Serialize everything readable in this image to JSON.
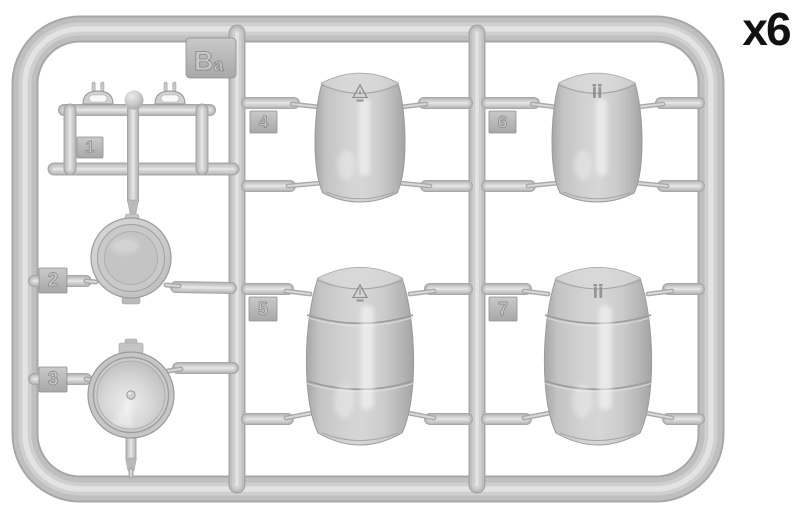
{
  "diagram": {
    "sprue_label": "Ba",
    "quantity_label": "x6",
    "palette": {
      "background": "#ffffff",
      "plastic_edge": "#a7a7a7",
      "plastic_base": "#bfbfbf",
      "plastic_mid": "#cfcfcf",
      "plastic_core": "#e3e3e3",
      "tab_stroke": "#8f8f8f",
      "emboss_fill": "#c8c8c8",
      "emboss_line": "#858585",
      "stamp_line": "#8a8a8a",
      "label_text": "#111111"
    },
    "parts": [
      {
        "number": "1",
        "name": "carry-handles-pair"
      },
      {
        "number": "2",
        "name": "flat-barrel-lid"
      },
      {
        "number": "3",
        "name": "barrel-lid-center-plug"
      },
      {
        "number": "4",
        "name": "small-barrel-half-triangle-stamp"
      },
      {
        "number": "5",
        "name": "large-barrel-triangle-stamp"
      },
      {
        "number": "6",
        "name": "small-barrel-half-jug-stamp"
      },
      {
        "number": "7",
        "name": "large-barrel-jug-stamp"
      }
    ]
  }
}
